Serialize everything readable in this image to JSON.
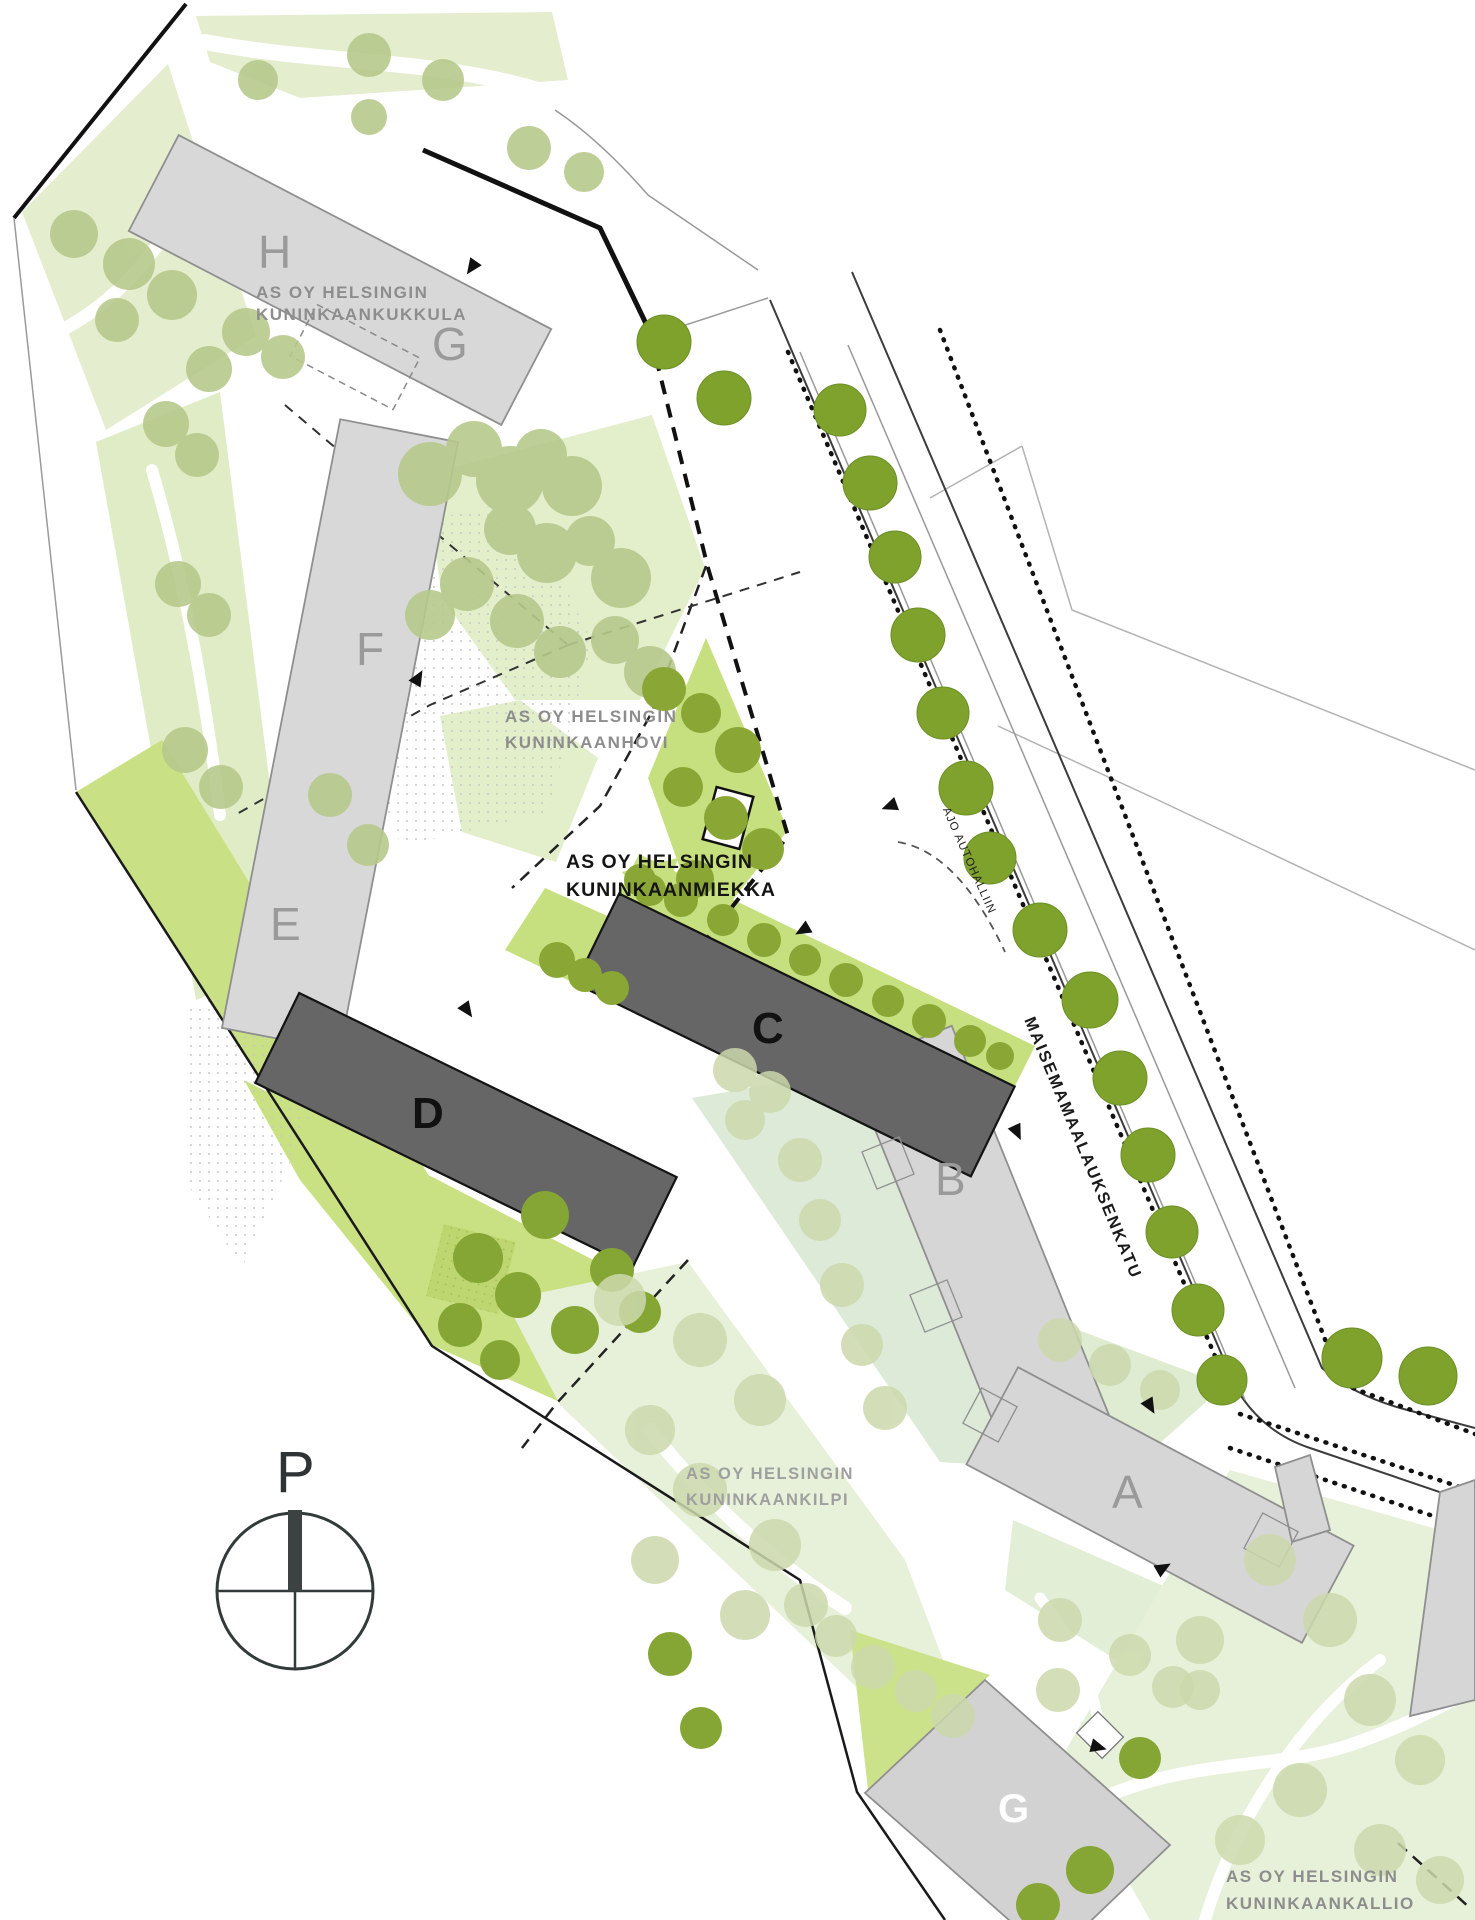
{
  "map": {
    "parcels": {
      "kukkula": {
        "line1": "AS OY HELSINGIN",
        "line2": "KUNINKAANKUKKULA"
      },
      "hovi": {
        "line1": "AS OY HELSINGIN",
        "line2": "KUNINKAANHOVI"
      },
      "miekka": {
        "line1": "AS OY HELSINGIN",
        "line2": "KUNINKAANMIEKKA"
      },
      "kilpi": {
        "line1": "AS OY HELSINGIN",
        "line2": "KUNINKAANKILPI"
      },
      "kallio": {
        "line1": "AS OY HELSINGIN",
        "line2": "KUNINKAANKALLIO"
      }
    },
    "buildings": {
      "h": "H",
      "g_top": "G",
      "f": "F",
      "e": "E",
      "d": "D",
      "c": "C",
      "b": "B",
      "a": "A",
      "g_bottom": "G"
    },
    "street": {
      "name": "MAISEMAMAALAUKSENKATU"
    },
    "annotations": {
      "driveway": "AJO AUTOHALLIIN"
    },
    "compass": {
      "label": "P"
    },
    "colors": {
      "lawn_pale": "#e7efd6",
      "lawn_bright": "#c6df7f",
      "tree_street": "#7fa22d",
      "tree_pale": "#b7c98c",
      "tree_faded": "#ccd9ad",
      "shrub": "#8aa736",
      "building_light": "#d8d8d8",
      "building_dark": "#666666",
      "label_gray": "#8d8d8d"
    }
  }
}
